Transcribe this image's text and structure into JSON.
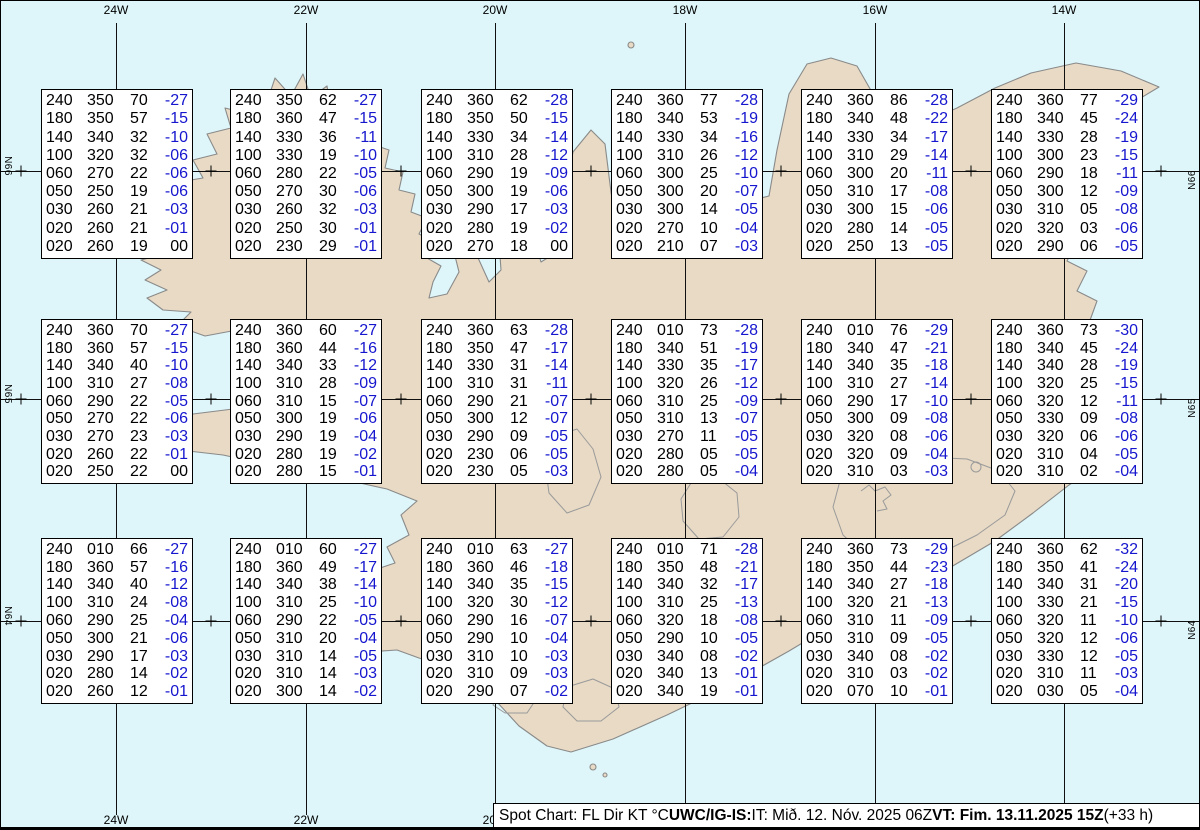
{
  "map": {
    "region_name": "Iceland",
    "meridian_labels": [
      "24W",
      "22W",
      "20W",
      "18W",
      "16W",
      "14W"
    ],
    "parallel_labels": [
      "N66",
      "N65",
      "N64"
    ],
    "icons": {
      "grid_cross": "+"
    },
    "colors": {
      "water": "#def6f9",
      "land": "#e8dac5",
      "coastline": "#8a8a8a",
      "glacier_outline": "#9a9a9a",
      "grid_line": "#101010",
      "temperature_blue": "#1616cf",
      "text_black": "#000000",
      "box_background": "#ffffff"
    }
  },
  "footer": {
    "segments": [
      {
        "text": "Spot Chart: FL Dir KT °C ",
        "bold": false
      },
      {
        "text": "UWC/IG-IS:",
        "bold": true
      },
      {
        "text": " IT: Mið. 12. Nóv. 2025 06Z ",
        "bold": false
      },
      {
        "text": "VT: Fim. 13.11.2025 15Z",
        "bold": true
      },
      {
        "text": " (+33 h)",
        "bold": false
      }
    ]
  },
  "chart_data": {
    "type": "table",
    "title": "Spot Chart: FL Dir KT °C",
    "columns": [
      "FL",
      "Dir",
      "KT",
      "°C"
    ],
    "issue_time": "IT: Mið. 12. Nóv. 2025 06Z",
    "valid_time": "VT: Fim. 13.11.2025 15Z (+33 h)",
    "grid": {
      "meridians": [
        "24W",
        "22W",
        "20W",
        "18W",
        "16W",
        "14W"
      ],
      "parallels": [
        "N66",
        "N65",
        "N64"
      ]
    },
    "spots": [
      {
        "cell": "r1c1",
        "levels": [
          [
            "240",
            "350",
            "70",
            "-27"
          ],
          [
            "180",
            "350",
            "57",
            "-15"
          ],
          [
            "140",
            "340",
            "32",
            "-10"
          ],
          [
            "100",
            "320",
            "32",
            "-06"
          ],
          [
            "060",
            "270",
            "22",
            "-06"
          ],
          [
            "050",
            "250",
            "19",
            "-06"
          ],
          [
            "030",
            "260",
            "21",
            "-03"
          ],
          [
            "020",
            "260",
            "21",
            "-01"
          ],
          [
            "020",
            "260",
            "19",
            "00"
          ]
        ]
      },
      {
        "cell": "r1c2",
        "levels": [
          [
            "240",
            "350",
            "62",
            "-27"
          ],
          [
            "180",
            "360",
            "47",
            "-15"
          ],
          [
            "140",
            "330",
            "36",
            "-11"
          ],
          [
            "100",
            "330",
            "19",
            "-10"
          ],
          [
            "060",
            "280",
            "22",
            "-05"
          ],
          [
            "050",
            "270",
            "30",
            "-06"
          ],
          [
            "030",
            "260",
            "32",
            "-03"
          ],
          [
            "020",
            "250",
            "30",
            "-01"
          ],
          [
            "020",
            "230",
            "29",
            "-01"
          ]
        ]
      },
      {
        "cell": "r1c3",
        "levels": [
          [
            "240",
            "360",
            "62",
            "-28"
          ],
          [
            "180",
            "350",
            "50",
            "-15"
          ],
          [
            "140",
            "330",
            "34",
            "-14"
          ],
          [
            "100",
            "310",
            "28",
            "-12"
          ],
          [
            "060",
            "290",
            "19",
            "-09"
          ],
          [
            "050",
            "300",
            "19",
            "-06"
          ],
          [
            "030",
            "290",
            "17",
            "-03"
          ],
          [
            "020",
            "280",
            "19",
            "-02"
          ],
          [
            "020",
            "270",
            "18",
            "00"
          ]
        ]
      },
      {
        "cell": "r1c4",
        "levels": [
          [
            "240",
            "360",
            "77",
            "-28"
          ],
          [
            "180",
            "340",
            "53",
            "-19"
          ],
          [
            "140",
            "330",
            "34",
            "-16"
          ],
          [
            "100",
            "310",
            "26",
            "-12"
          ],
          [
            "060",
            "300",
            "25",
            "-10"
          ],
          [
            "050",
            "300",
            "20",
            "-07"
          ],
          [
            "030",
            "300",
            "14",
            "-05"
          ],
          [
            "020",
            "270",
            "10",
            "-04"
          ],
          [
            "020",
            "210",
            "07",
            "-03"
          ]
        ]
      },
      {
        "cell": "r1c5",
        "levels": [
          [
            "240",
            "360",
            "86",
            "-28"
          ],
          [
            "180",
            "340",
            "48",
            "-22"
          ],
          [
            "140",
            "330",
            "34",
            "-17"
          ],
          [
            "100",
            "310",
            "29",
            "-14"
          ],
          [
            "060",
            "300",
            "20",
            "-11"
          ],
          [
            "050",
            "310",
            "17",
            "-08"
          ],
          [
            "030",
            "300",
            "15",
            "-06"
          ],
          [
            "020",
            "280",
            "14",
            "-05"
          ],
          [
            "020",
            "250",
            "13",
            "-05"
          ]
        ]
      },
      {
        "cell": "r1c6",
        "levels": [
          [
            "240",
            "360",
            "77",
            "-29"
          ],
          [
            "180",
            "340",
            "45",
            "-24"
          ],
          [
            "140",
            "330",
            "28",
            "-19"
          ],
          [
            "100",
            "300",
            "23",
            "-15"
          ],
          [
            "060",
            "290",
            "18",
            "-11"
          ],
          [
            "050",
            "300",
            "12",
            "-09"
          ],
          [
            "030",
            "310",
            "05",
            "-08"
          ],
          [
            "020",
            "320",
            "03",
            "-06"
          ],
          [
            "020",
            "290",
            "06",
            "-05"
          ]
        ]
      },
      {
        "cell": "r2c1",
        "levels": [
          [
            "240",
            "360",
            "70",
            "-27"
          ],
          [
            "180",
            "360",
            "57",
            "-15"
          ],
          [
            "140",
            "340",
            "40",
            "-10"
          ],
          [
            "100",
            "310",
            "27",
            "-08"
          ],
          [
            "060",
            "290",
            "22",
            "-05"
          ],
          [
            "050",
            "270",
            "22",
            "-06"
          ],
          [
            "030",
            "270",
            "23",
            "-03"
          ],
          [
            "020",
            "260",
            "22",
            "-01"
          ],
          [
            "020",
            "250",
            "22",
            "00"
          ]
        ]
      },
      {
        "cell": "r2c2",
        "levels": [
          [
            "240",
            "360",
            "60",
            "-27"
          ],
          [
            "180",
            "360",
            "44",
            "-16"
          ],
          [
            "140",
            "340",
            "33",
            "-12"
          ],
          [
            "100",
            "310",
            "28",
            "-09"
          ],
          [
            "060",
            "310",
            "15",
            "-07"
          ],
          [
            "050",
            "300",
            "19",
            "-06"
          ],
          [
            "030",
            "290",
            "19",
            "-04"
          ],
          [
            "020",
            "280",
            "19",
            "-02"
          ],
          [
            "020",
            "280",
            "15",
            "-01"
          ]
        ]
      },
      {
        "cell": "r2c3",
        "levels": [
          [
            "240",
            "360",
            "63",
            "-28"
          ],
          [
            "180",
            "350",
            "47",
            "-17"
          ],
          [
            "140",
            "330",
            "31",
            "-14"
          ],
          [
            "100",
            "310",
            "31",
            "-11"
          ],
          [
            "060",
            "290",
            "21",
            "-07"
          ],
          [
            "050",
            "300",
            "12",
            "-07"
          ],
          [
            "030",
            "290",
            "09",
            "-05"
          ],
          [
            "020",
            "230",
            "06",
            "-05"
          ],
          [
            "020",
            "230",
            "05",
            "-03"
          ]
        ]
      },
      {
        "cell": "r2c4",
        "levels": [
          [
            "240",
            "010",
            "73",
            "-28"
          ],
          [
            "180",
            "340",
            "51",
            "-19"
          ],
          [
            "140",
            "330",
            "35",
            "-17"
          ],
          [
            "100",
            "320",
            "26",
            "-12"
          ],
          [
            "060",
            "310",
            "25",
            "-09"
          ],
          [
            "050",
            "310",
            "13",
            "-07"
          ],
          [
            "030",
            "270",
            "11",
            "-05"
          ],
          [
            "020",
            "280",
            "05",
            "-05"
          ],
          [
            "020",
            "280",
            "05",
            "-04"
          ]
        ]
      },
      {
        "cell": "r2c5",
        "levels": [
          [
            "240",
            "010",
            "76",
            "-29"
          ],
          [
            "180",
            "340",
            "47",
            "-21"
          ],
          [
            "140",
            "340",
            "35",
            "-18"
          ],
          [
            "100",
            "310",
            "27",
            "-14"
          ],
          [
            "060",
            "290",
            "17",
            "-10"
          ],
          [
            "050",
            "300",
            "09",
            "-08"
          ],
          [
            "030",
            "320",
            "08",
            "-06"
          ],
          [
            "020",
            "320",
            "09",
            "-04"
          ],
          [
            "020",
            "310",
            "03",
            "-03"
          ]
        ]
      },
      {
        "cell": "r2c6",
        "levels": [
          [
            "240",
            "360",
            "73",
            "-30"
          ],
          [
            "180",
            "340",
            "45",
            "-24"
          ],
          [
            "140",
            "340",
            "28",
            "-19"
          ],
          [
            "100",
            "320",
            "25",
            "-15"
          ],
          [
            "060",
            "320",
            "12",
            "-11"
          ],
          [
            "050",
            "330",
            "09",
            "-08"
          ],
          [
            "030",
            "320",
            "06",
            "-06"
          ],
          [
            "020",
            "310",
            "04",
            "-05"
          ],
          [
            "020",
            "310",
            "02",
            "-04"
          ]
        ]
      },
      {
        "cell": "r3c1",
        "levels": [
          [
            "240",
            "010",
            "66",
            "-27"
          ],
          [
            "180",
            "360",
            "57",
            "-16"
          ],
          [
            "140",
            "340",
            "40",
            "-12"
          ],
          [
            "100",
            "310",
            "24",
            "-08"
          ],
          [
            "060",
            "290",
            "25",
            "-04"
          ],
          [
            "050",
            "300",
            "21",
            "-06"
          ],
          [
            "030",
            "290",
            "17",
            "-03"
          ],
          [
            "020",
            "280",
            "14",
            "-02"
          ],
          [
            "020",
            "260",
            "12",
            "-01"
          ]
        ]
      },
      {
        "cell": "r3c2",
        "levels": [
          [
            "240",
            "010",
            "60",
            "-27"
          ],
          [
            "180",
            "360",
            "49",
            "-17"
          ],
          [
            "140",
            "340",
            "38",
            "-14"
          ],
          [
            "100",
            "310",
            "25",
            "-10"
          ],
          [
            "060",
            "290",
            "22",
            "-05"
          ],
          [
            "050",
            "310",
            "20",
            "-04"
          ],
          [
            "030",
            "310",
            "14",
            "-05"
          ],
          [
            "020",
            "310",
            "14",
            "-03"
          ],
          [
            "020",
            "300",
            "14",
            "-02"
          ]
        ]
      },
      {
        "cell": "r3c3",
        "levels": [
          [
            "240",
            "010",
            "63",
            "-27"
          ],
          [
            "180",
            "360",
            "46",
            "-18"
          ],
          [
            "140",
            "340",
            "35",
            "-15"
          ],
          [
            "100",
            "320",
            "30",
            "-12"
          ],
          [
            "060",
            "290",
            "16",
            "-07"
          ],
          [
            "050",
            "290",
            "10",
            "-04"
          ],
          [
            "030",
            "310",
            "10",
            "-03"
          ],
          [
            "020",
            "310",
            "09",
            "-03"
          ],
          [
            "020",
            "290",
            "07",
            "-02"
          ]
        ]
      },
      {
        "cell": "r3c4",
        "levels": [
          [
            "240",
            "010",
            "71",
            "-28"
          ],
          [
            "180",
            "350",
            "48",
            "-21"
          ],
          [
            "140",
            "340",
            "32",
            "-17"
          ],
          [
            "100",
            "310",
            "25",
            "-13"
          ],
          [
            "060",
            "320",
            "18",
            "-08"
          ],
          [
            "050",
            "290",
            "10",
            "-05"
          ],
          [
            "030",
            "340",
            "08",
            "-02"
          ],
          [
            "020",
            "340",
            "13",
            "-01"
          ],
          [
            "020",
            "340",
            "19",
            "-01"
          ]
        ]
      },
      {
        "cell": "r3c5",
        "levels": [
          [
            "240",
            "360",
            "73",
            "-29"
          ],
          [
            "180",
            "350",
            "44",
            "-23"
          ],
          [
            "140",
            "340",
            "27",
            "-18"
          ],
          [
            "100",
            "320",
            "21",
            "-13"
          ],
          [
            "060",
            "310",
            "11",
            "-09"
          ],
          [
            "050",
            "310",
            "09",
            "-05"
          ],
          [
            "030",
            "340",
            "08",
            "-02"
          ],
          [
            "020",
            "310",
            "03",
            "-02"
          ],
          [
            "020",
            "070",
            "10",
            "-01"
          ]
        ]
      },
      {
        "cell": "r3c6",
        "levels": [
          [
            "240",
            "360",
            "62",
            "-32"
          ],
          [
            "180",
            "350",
            "41",
            "-24"
          ],
          [
            "140",
            "340",
            "31",
            "-20"
          ],
          [
            "100",
            "330",
            "21",
            "-15"
          ],
          [
            "060",
            "320",
            "11",
            "-10"
          ],
          [
            "050",
            "320",
            "12",
            "-06"
          ],
          [
            "030",
            "330",
            "12",
            "-05"
          ],
          [
            "020",
            "310",
            "11",
            "-03"
          ],
          [
            "020",
            "030",
            "05",
            "-04"
          ]
        ]
      }
    ]
  }
}
